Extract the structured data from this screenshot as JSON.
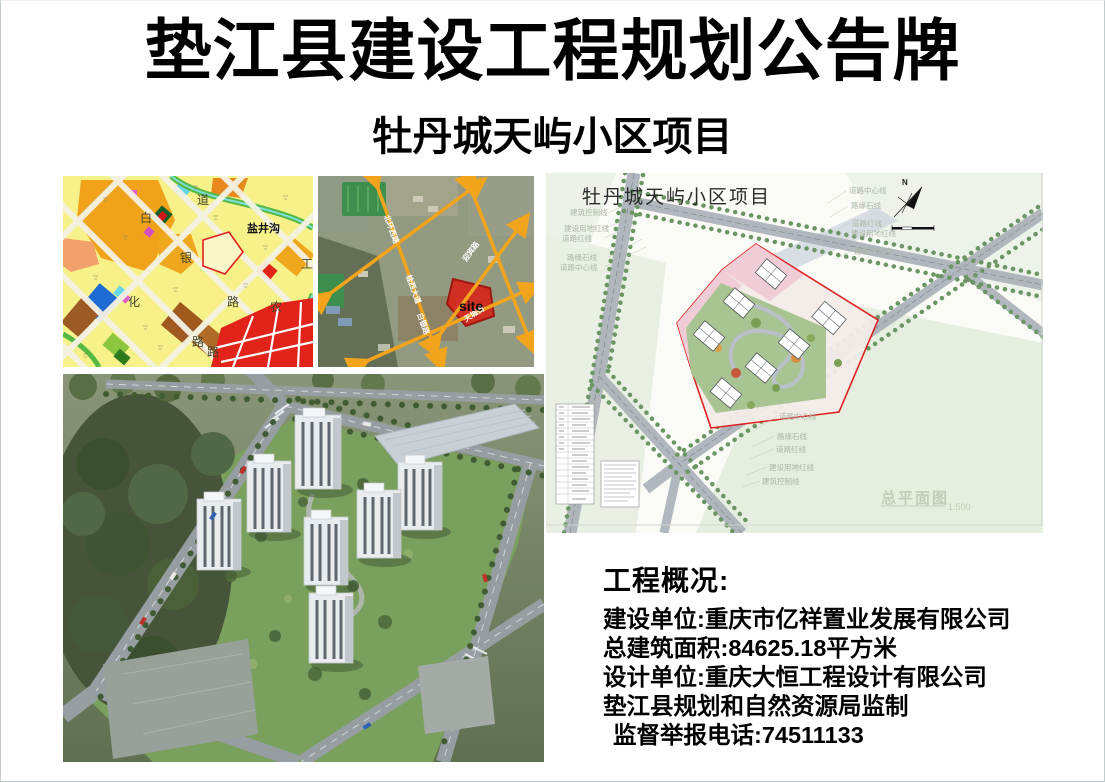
{
  "colors": {
    "boundary_red": "#e01818",
    "site_red": "#d5281c",
    "arrow_orange": "#f2a41c",
    "zoning_yellow": "#f7f18a"
  },
  "board": {
    "title": "垫江县建设工程规划公告牌",
    "subtitle": "牡丹城天屿小区项目"
  },
  "zoning_map": {
    "chars": {
      "c1": "道",
      "c2": "白",
      "c3": "盐井沟",
      "c4": "银",
      "c5": "工",
      "c6": "化",
      "c7": "路",
      "c8": "农",
      "c9": "路",
      "c10": "路"
    }
  },
  "satellite_map": {
    "site_label": "site",
    "roads": {
      "r1": "北环西路",
      "r2": "桂西大道",
      "r3": "白银路",
      "r4": "迎宾路",
      "r5": "天城街"
    }
  },
  "site_plan": {
    "title": "牡丹城天屿小区项目",
    "north": "N",
    "drawing_title": "总平面图",
    "scale": "1:500",
    "labels_left": [
      "建筑控制线",
      "建设用地红线",
      "道路红线",
      "路缘石线",
      "道路中心线"
    ],
    "labels_right": [
      "道路中心线",
      "路缘石线",
      "道路红线",
      "建设用地红线",
      "建筑控制线"
    ],
    "labels_bottom": [
      "道路中心线",
      "路缘石线",
      "道路红线",
      "建设用地红线",
      "建筑控制线"
    ]
  },
  "info": {
    "heading": "工程概况:",
    "line1": "建设单位:重庆市亿祥置业发展有限公司",
    "line2": "总建筑面积:84625.18平方米",
    "line3": "设计单位:重庆大恒工程设计有限公司",
    "line4": "垫江县规划和自然资源局监制",
    "line5": "监督举报电话:74511133"
  }
}
